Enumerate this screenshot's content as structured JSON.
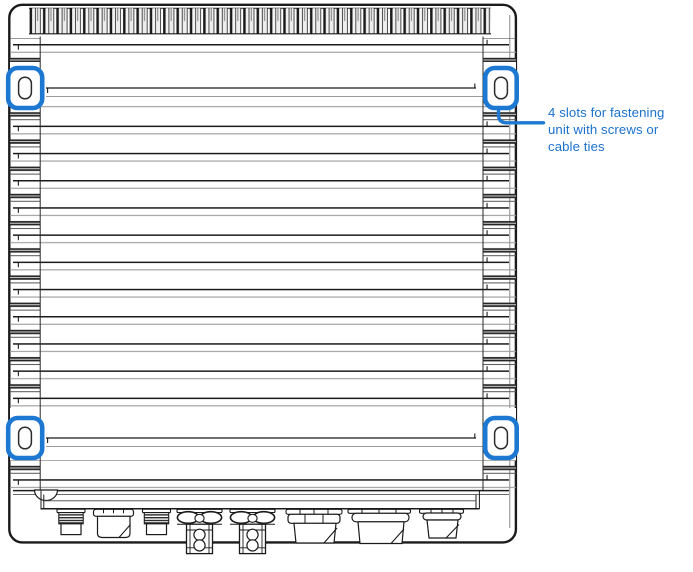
{
  "annotation": {
    "full_text": "4 slots for fastening unit with screws or cable ties",
    "lines": [
      "4 slots for fastening",
      "unit with screws or",
      "cable ties"
    ]
  },
  "slots": {
    "count": 4,
    "positions": [
      "top-left",
      "top-right",
      "bottom-left",
      "bottom-right"
    ]
  },
  "colors": {
    "highlight_blue": "#1d78d2",
    "annotation_text": "#1b72cc",
    "line_dark": "#1b1b1b",
    "line_gray": "#9b9b9b",
    "background": "#ffffff"
  }
}
